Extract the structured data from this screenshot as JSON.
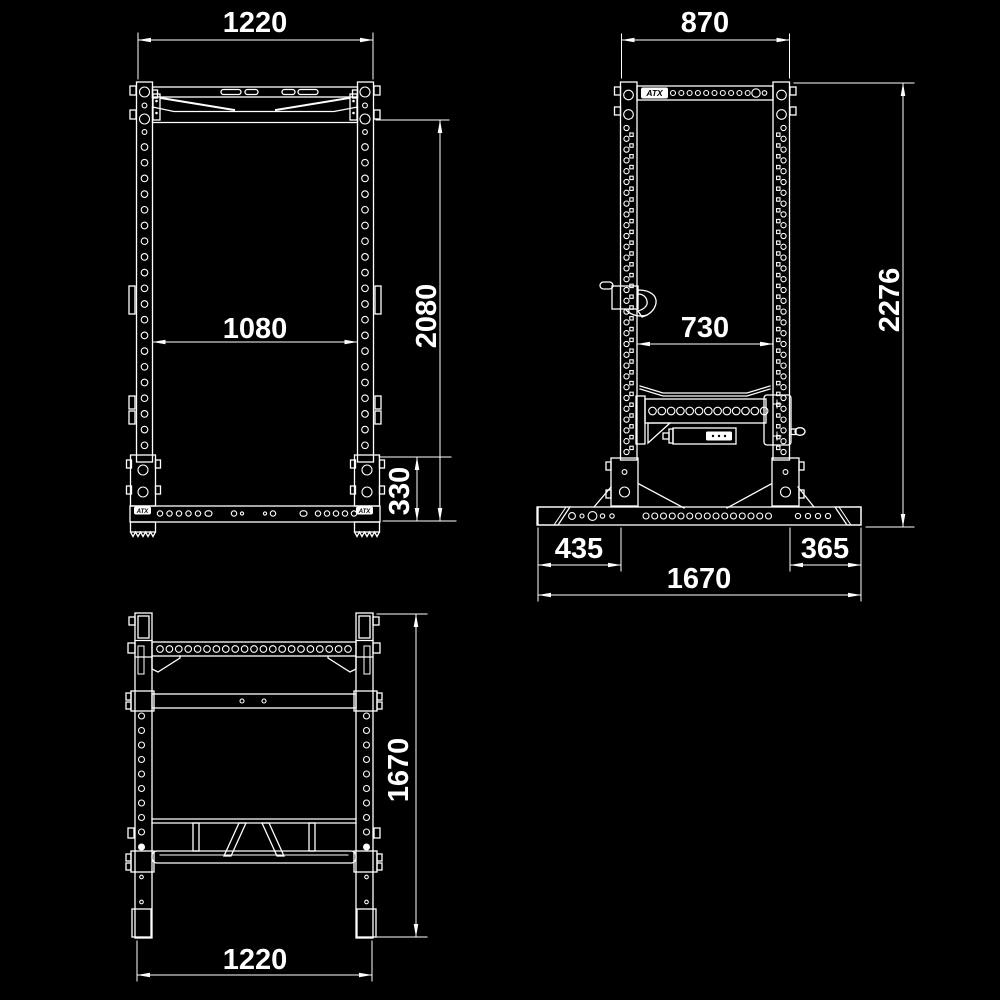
{
  "colors": {
    "background": "#000000",
    "line": "#ffffff"
  },
  "brand": {
    "logo": "ATX"
  },
  "views": {
    "front": {
      "dims": {
        "overall_width": "1220",
        "inner_width": "1080",
        "height": "2080",
        "base_height": "330"
      }
    },
    "side": {
      "dims": {
        "top_depth": "870",
        "inner_depth": "730",
        "overall_height": "2276",
        "front_foot": "435",
        "rear_foot": "365",
        "overall_depth": "1670"
      }
    },
    "top": {
      "dims": {
        "overall_depth": "1670",
        "overall_width": "1220"
      }
    }
  }
}
